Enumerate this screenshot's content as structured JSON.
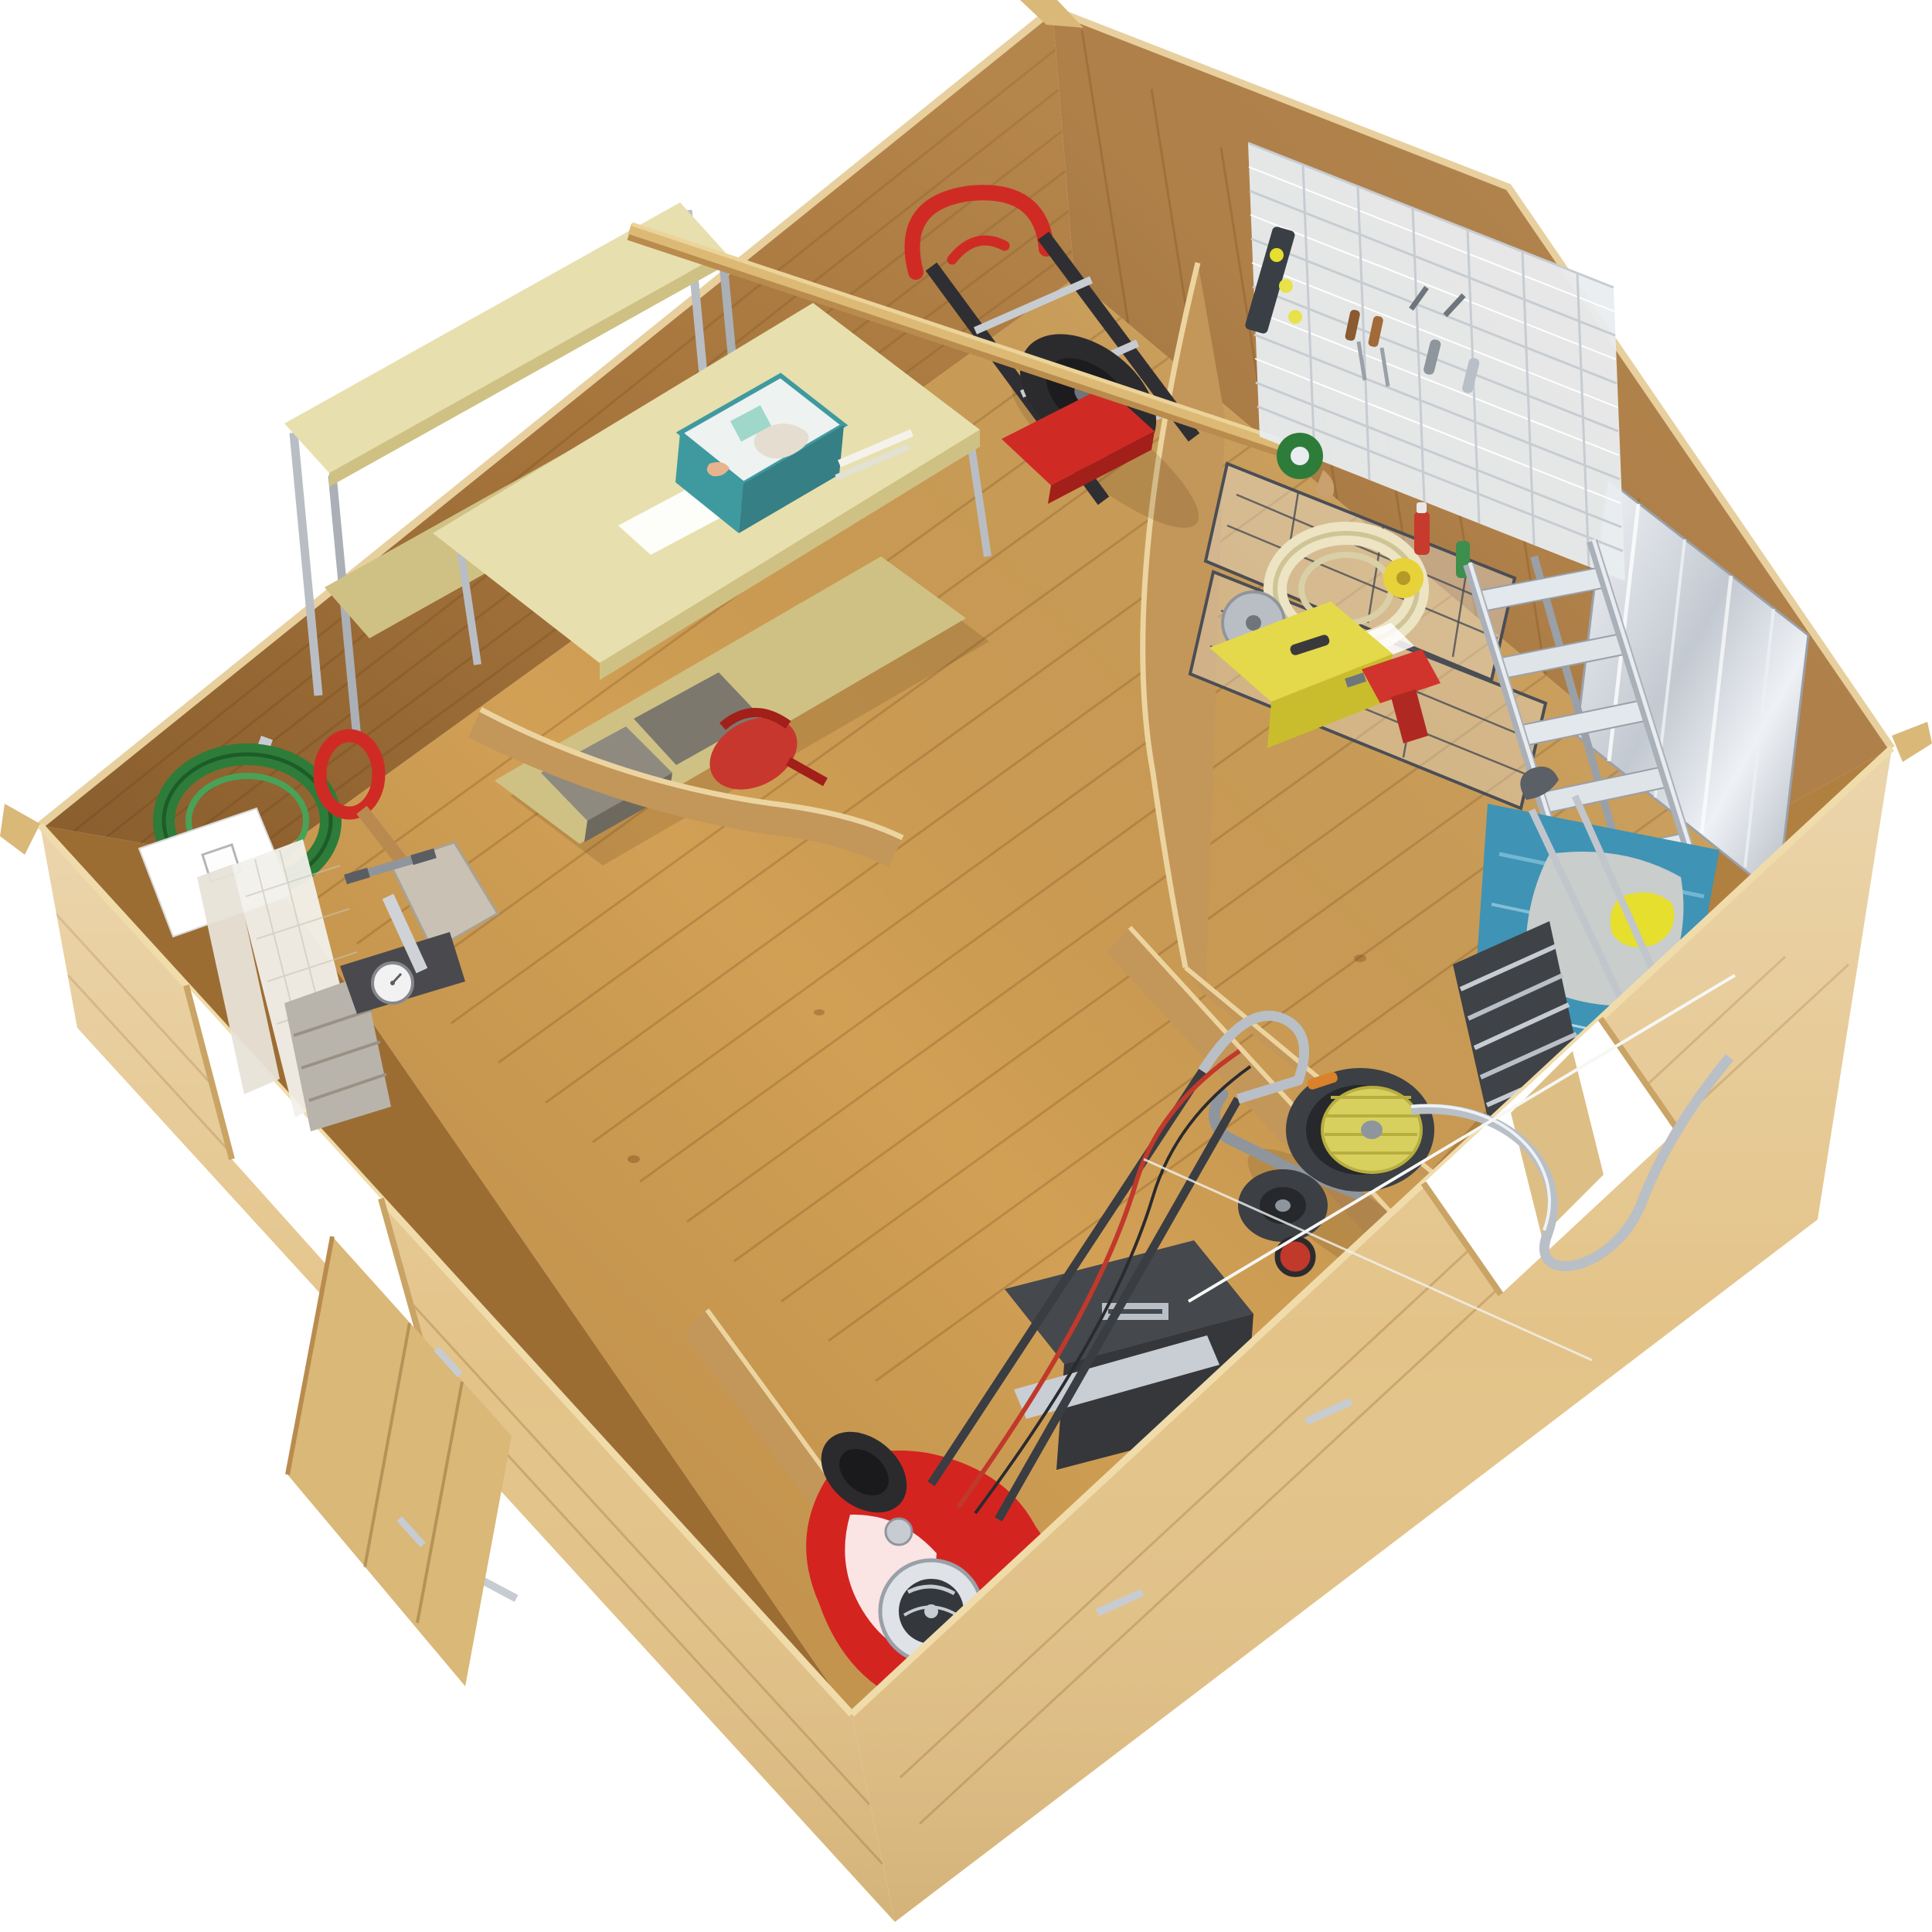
{
  "meta": {
    "background": "#ffffff",
    "subject": "wooden garden shed interior, overhead cutaway 3d render",
    "view": "aerial isometric, walls cut away in curves, no text visible"
  },
  "colors": {
    "background": "#ffffff",
    "wood_floor": "#d2a055",
    "wood_floor_seam": "#8a5a26",
    "wood_wall": "#ad7b40",
    "wood_wall_gable": "#b5854c",
    "wood_wall_inner": "#9c6d33",
    "wood_wall_inner_se": "#b08040",
    "wood_outer": "#e3c388",
    "wood_outer_light": "#efd9ab",
    "wood_partition": "#c39659",
    "wood_beam": "#dcba76",
    "wood_door": "#d9b878",
    "osb": "#e7dfae",
    "osb_edge": "#cfc183",
    "metal": "#c7ccd2",
    "metal_bright": "#eef1f5",
    "metal_dark": "#6f757c",
    "chrome_panel": "#e9edf0",
    "wire_basket": "#4a4e55",
    "teal": "#3f9aa0",
    "teal_dark": "#357f85",
    "green_box": "#3e8e4e",
    "hose_green": "#2e7c39",
    "hose_cream": "#ece4c2",
    "yellow_case": "#e3d94b",
    "yellow_bottle": "#e8d23a",
    "reel_yellow": "#d8d05e",
    "glove_yellow": "#e6df2e",
    "orange_cable": "#d77c3f",
    "red": "#cf2b24",
    "mower_red": "#d42420",
    "watering_can_red": "#c8372d",
    "tire_black": "#2b2b2e",
    "grass_box": "#45484d",
    "tarp_blue": "#3f93b5",
    "mat_grey": "#c9cdcb",
    "bin_grey": "#8f8a80",
    "mesh_white": "#f2f0ea",
    "sign_white": "#ffffff"
  },
  "scene": {
    "structure": [
      {
        "name": "floor",
        "material": "pine planks",
        "color": "#d2a055"
      },
      {
        "name": "left-wall",
        "color": "#ad7b40"
      },
      {
        "name": "gable-wall",
        "color": "#b5854c"
      },
      {
        "name": "front-wall-outer",
        "color": "#e3c388"
      },
      {
        "name": "side-wall-outer",
        "color": "#e3c388"
      },
      {
        "name": "open-door-leaf",
        "color": "#d9b878"
      },
      {
        "name": "doorway-front",
        "state": "open"
      },
      {
        "name": "doorway-side",
        "state": "open"
      },
      {
        "name": "partition-curved-main",
        "color": "#c39659"
      },
      {
        "name": "partition-workbench",
        "color": "#c39659"
      },
      {
        "name": "mower-bay-walls",
        "color": "#c39659"
      },
      {
        "name": "roof-beam",
        "color": "#dcba76"
      }
    ],
    "objects": [
      {
        "name": "garden-hose-coil",
        "color": "#2e7c39",
        "location": "left wall hook"
      },
      {
        "name": "hanging-sign",
        "color": "#ffffff",
        "location": "left wall"
      },
      {
        "name": "spade",
        "color": "#cf2b24",
        "location": "left wall"
      },
      {
        "name": "window-screens",
        "color": "#f2f0ea",
        "location": "door corner"
      },
      {
        "name": "storage-basket",
        "color": "#b9b4ab",
        "location": "door corner"
      },
      {
        "name": "bicycle-pump",
        "color": "#c7ccd2",
        "location": "floor near door"
      },
      {
        "name": "shelving-unit-osb",
        "color": "#e7dfae",
        "location": "workbench room"
      },
      {
        "name": "spray-bottle",
        "color": "#e8d23a",
        "location": "shelf"
      },
      {
        "name": "green-box",
        "color": "#3e8e4e",
        "location": "shelf"
      },
      {
        "name": "parts-organizer",
        "color": "#c7ccd2",
        "location": "shelf"
      },
      {
        "name": "workbench-osb",
        "color": "#e7dfae",
        "location": "workbench room"
      },
      {
        "name": "extension-cord-reel",
        "color": "#d77c3f",
        "location": "workbench top"
      },
      {
        "name": "tool-tote-with-gloves",
        "color": "#3f9aa0",
        "location": "workbench top"
      },
      {
        "name": "storage-bins",
        "color": "#8f8a80",
        "location": "under bench"
      },
      {
        "name": "watering-can",
        "color": "#c8372d",
        "location": "under bench"
      },
      {
        "name": "hand-truck",
        "color": "#cf2b24",
        "location": "against partition"
      },
      {
        "name": "wire-grid-panel",
        "color": "#e9edf0",
        "location": "gable wall, tool room"
      },
      {
        "name": "spirit-level",
        "color": "#3a3f45",
        "location": "wire grid"
      },
      {
        "name": "screwdrivers",
        "color": "#b07a45",
        "location": "wire grid"
      },
      {
        "name": "wire-baskets",
        "color": "#4a4e55",
        "location": "tool room"
      },
      {
        "name": "coiled-hose-cream",
        "color": "#ece4c2",
        "location": "wire basket"
      },
      {
        "name": "aerosol-cans",
        "color": "#c63b2e",
        "location": "wire basket"
      },
      {
        "name": "tape-roll",
        "color": "#2f7d3a",
        "location": "wire basket"
      },
      {
        "name": "tool-case-yellow",
        "color": "#e3d94b",
        "location": "tool room floor"
      },
      {
        "name": "power-drill",
        "color": "#d0342c",
        "location": "tool room floor"
      },
      {
        "name": "chrome-shelving-stack",
        "color": "#c7ccd2",
        "location": "tool room"
      },
      {
        "name": "step-ladder",
        "color": "#c7ccd2",
        "location": "tool room"
      },
      {
        "name": "tarpaulin",
        "color": "#3f93b5",
        "location": "tool room floor"
      },
      {
        "name": "kneeling-mat",
        "color": "#c9cdcb",
        "location": "on tarpaulin"
      },
      {
        "name": "rubber-gloves",
        "color": "#e6df2e",
        "location": "on tarpaulin"
      },
      {
        "name": "loppers",
        "color": "#58a06a",
        "location": "on tarpaulin"
      },
      {
        "name": "hose-reel-cart",
        "color": "#d8d05e",
        "location": "side corridor"
      },
      {
        "name": "silver-hose",
        "color": "#b9bfc6",
        "location": "through side doorway"
      },
      {
        "name": "lawn-mower",
        "color": "#d42420",
        "location": "mower bay"
      },
      {
        "name": "grass-catcher",
        "color": "#45484d",
        "location": "mower bay"
      }
    ]
  }
}
